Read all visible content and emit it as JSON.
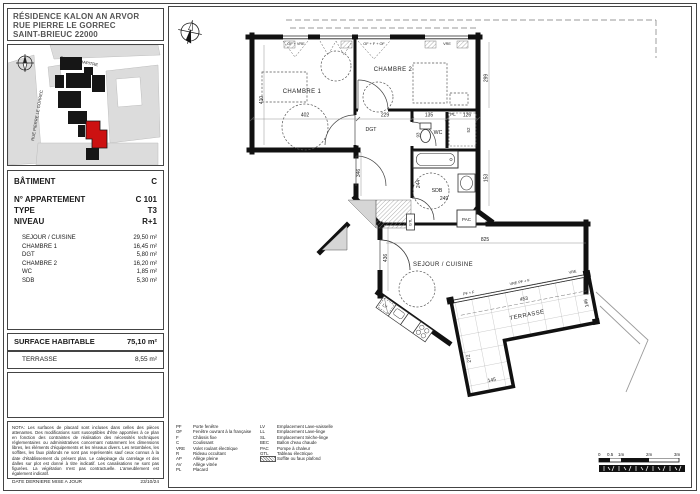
{
  "header": {
    "line1": "RÉSIDENCE KALON AN ARVOR",
    "line2": "RUE PIERRE LE GORREC",
    "line3": "SAINT-BRIEUC 22000"
  },
  "site_map": {
    "street1": "RUE DU CHAPITRE",
    "street2": "RUE PIERRE LE GORREC",
    "highlight_color": "#cc1111"
  },
  "info": {
    "batiment_label": "BÂTIMENT",
    "batiment_value": "C",
    "apartment_label": "N° APPARTEMENT",
    "apartment_value": "C 101",
    "type_label": "TYPE",
    "type_value": "T3",
    "niveau_label": "NIVEAU",
    "niveau_value": "R+1",
    "rooms": [
      {
        "name": "SEJOUR / CUISINE",
        "area": "29,50 m²"
      },
      {
        "name": "CHAMBRE 1",
        "area": "16,45 m²"
      },
      {
        "name": "DGT",
        "area": "5,80 m²"
      },
      {
        "name": "CHAMBRE 2",
        "area": "16,20 m²"
      },
      {
        "name": "WC",
        "area": "1,85 m²"
      },
      {
        "name": "SDB",
        "area": "5,30 m²"
      }
    ]
  },
  "surface": {
    "label": "SURFACE HABITABLE",
    "value": "75,10 m²"
  },
  "terrasse_row": {
    "label": "TERRASSE",
    "value": "8,55 m²"
  },
  "nota": {
    "text": "NOTA: Les surfaces de placard sont incluses dans celles des pièces attenantes. Des modifications sont susceptibles d'être apportées à ce plan en fonction des contraintes de réalisation des nécessités techniques réglementaires ou administratives concernant notamment les dimensions libres, les éléments d'équipements et les réseaux divers. Les retombées, les soffites, les faux plafonds ne sont pas représentés sauf ceux connus à la date d'établissement du présent plan. Le calepinage du carrelage et des dalles sur plot est donné à titre indicatif. Les canalisations ne sont pas figurées. La végétation n'est pas contractuelle. L'ameublement est également indicatif.",
    "date_label": "DATE DERNIERE MISE A JOUR",
    "date_value": "23/10/24"
  },
  "legend": {
    "col1": [
      {
        "abbr": "PF",
        "label": "Porte fenêtre"
      },
      {
        "abbr": "OF",
        "label": "Fenêtre ouvrant à la française"
      },
      {
        "abbr": "F",
        "label": "Châssis fixe"
      },
      {
        "abbr": "C",
        "label": "Coulissant"
      },
      {
        "abbr": "VRE",
        "label": "Volet roulant électrique"
      },
      {
        "abbr": "R",
        "label": "Rideau occultant"
      },
      {
        "abbr": "AP",
        "label": "Allège pleine"
      },
      {
        "abbr": "AV",
        "label": "Allège vitrée"
      },
      {
        "abbr": "PL",
        "label": "Placard"
      }
    ],
    "col2": [
      {
        "abbr": "LV",
        "label": "Emplacement Lave-vaisselle"
      },
      {
        "abbr": "LL",
        "label": "Emplacement Lave-linge"
      },
      {
        "abbr": "SL",
        "label": "Emplacement Sèche-linge"
      },
      {
        "abbr": "BEC",
        "label": "Ballon d'eau chaude"
      },
      {
        "abbr": "PAC",
        "label": "Pompe à chaleur"
      },
      {
        "abbr": "GTL",
        "label": "Tableau électrique"
      },
      {
        "abbr": "",
        "label": "Soffite ou faux plafond"
      }
    ]
  },
  "scalebar": {
    "l0": "0",
    "l05": "0.5",
    "l1": "1m",
    "l2": "2m",
    "l3": "3m"
  },
  "plan": {
    "rooms": {
      "chambre1": "CHAMBRE 1",
      "chambre2": "CHAMBRE 2",
      "dgt": "DGT",
      "wc": "WC",
      "sdb": "SDB",
      "sejour": "SEJOUR / CUISINE",
      "terrasse": "TERRASSE"
    },
    "dims": {
      "d402": "402",
      "d410": "410",
      "d229": "229",
      "d135": "135",
      "d126": "126",
      "d52": "52",
      "d299": "299",
      "d153": "153",
      "d93": "93",
      "d244": "244",
      "d249": "249",
      "d346": "346",
      "d825": "825",
      "d436": "436",
      "d453": "453",
      "d146": "146",
      "d272": "272",
      "d145": "145"
    },
    "windows": {
      "w1": "OF + VRE",
      "w2": "OF + F + OF",
      "w3": "VRE",
      "t1": "PF + F",
      "t2": "VRE  PF + F",
      "t3": "VRE"
    },
    "equip": {
      "pl": "PL",
      "pac": "PAC",
      "gtl": "GTL",
      "lv": "LV"
    }
  }
}
